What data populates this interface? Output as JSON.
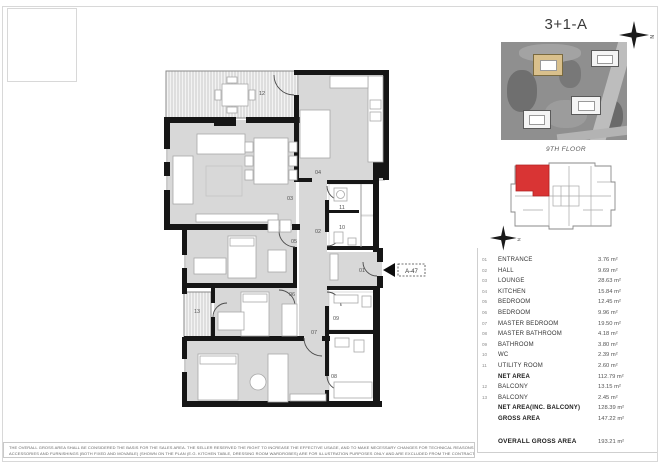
{
  "header": {
    "title": "3+1-A",
    "floor_label": "9TH FLOOR"
  },
  "compass": {
    "letter": "N"
  },
  "plan": {
    "unit_tag": "A-47",
    "room_labels": [
      {
        "id": "12",
        "x": 262,
        "y": 95
      },
      {
        "id": "03",
        "x": 290,
        "y": 200
      },
      {
        "id": "04",
        "x": 318,
        "y": 174
      },
      {
        "id": "02",
        "x": 318,
        "y": 233
      },
      {
        "id": "11",
        "x": 342,
        "y": 209
      },
      {
        "id": "10",
        "x": 342,
        "y": 229
      },
      {
        "id": "05",
        "x": 294,
        "y": 243
      },
      {
        "id": "06",
        "x": 292,
        "y": 296
      },
      {
        "id": "13",
        "x": 197,
        "y": 313
      },
      {
        "id": "07",
        "x": 314,
        "y": 334
      },
      {
        "id": "01",
        "x": 362,
        "y": 272
      },
      {
        "id": "09",
        "x": 336,
        "y": 320
      },
      {
        "id": "08",
        "x": 334,
        "y": 378
      }
    ]
  },
  "area_table": {
    "rows": [
      {
        "num": "01",
        "label": "ENTRANCE",
        "value": "3.76 m²",
        "bold": false
      },
      {
        "num": "02",
        "label": "HALL",
        "value": "9.69 m²",
        "bold": false
      },
      {
        "num": "03",
        "label": "LOUNGE",
        "value": "28.63 m²",
        "bold": false
      },
      {
        "num": "04",
        "label": "KITCHEN",
        "value": "15.84 m²",
        "bold": false
      },
      {
        "num": "05",
        "label": "BEDROOM",
        "value": "12.45 m²",
        "bold": false
      },
      {
        "num": "06",
        "label": "BEDROOM",
        "value": "9.96 m²",
        "bold": false
      },
      {
        "num": "07",
        "label": "MASTER BEDROOM",
        "value": "19.50 m²",
        "bold": false
      },
      {
        "num": "08",
        "label": "MASTER BATHROOM",
        "value": "4.18 m²",
        "bold": false
      },
      {
        "num": "09",
        "label": "BATHROOM",
        "value": "3.80 m²",
        "bold": false
      },
      {
        "num": "10",
        "label": "WC",
        "value": "2.39 m²",
        "bold": false
      },
      {
        "num": "11",
        "label": "UTILITY ROOM",
        "value": "2.60 m²",
        "bold": false
      },
      {
        "num": "",
        "label": "NET AREA",
        "value": "112.79 m²",
        "bold": true
      },
      {
        "num": "12",
        "label": "BALCONY",
        "value": "13.15 m²",
        "bold": false
      },
      {
        "num": "13",
        "label": "BALCONY",
        "value": "2.45 m²",
        "bold": false
      },
      {
        "num": "",
        "label": "NET AREA(INC. BALCONY)",
        "value": "128.39 m²",
        "bold": true
      },
      {
        "num": "",
        "label": "GROSS AREA",
        "value": "147.22 m²",
        "bold": true
      }
    ],
    "overall": {
      "label": "OVERALL GROSS AREA",
      "value": "193.21 m²"
    }
  },
  "disclaimer": {
    "line1": "THE OVERALL GROSS AREA SHALL BE CONSIDERED THE BASIS FOR THE SALES AREA. THE SELLER RESERVED THE RIGHT TO INCREASE THE EFFECTIVE USAGE, AND TO MAKE NECESSARY CHANGES FOR TECHNICAL REASONS TO THE DESIGN (E.G. TO FACADES, LANDSCAPE ETC.). ALL",
    "line2": "ACCESSORIES AND FURNISHINGS (BOTH FIXED AND MOVABLE) (SHOWN ON THE PLAN (E.G. KITCHEN TABLE, DRESSING ROOM WARDROBES) ARE FOR ILLUSTRATION PURPOSES ONLY AND ARE EXCLUDED FROM THE CONTRACT)"
  },
  "colors": {
    "unit_highlight": "#d93434",
    "plan_floor": "#d8d8d8",
    "building_highlight": "#d9c08c"
  }
}
